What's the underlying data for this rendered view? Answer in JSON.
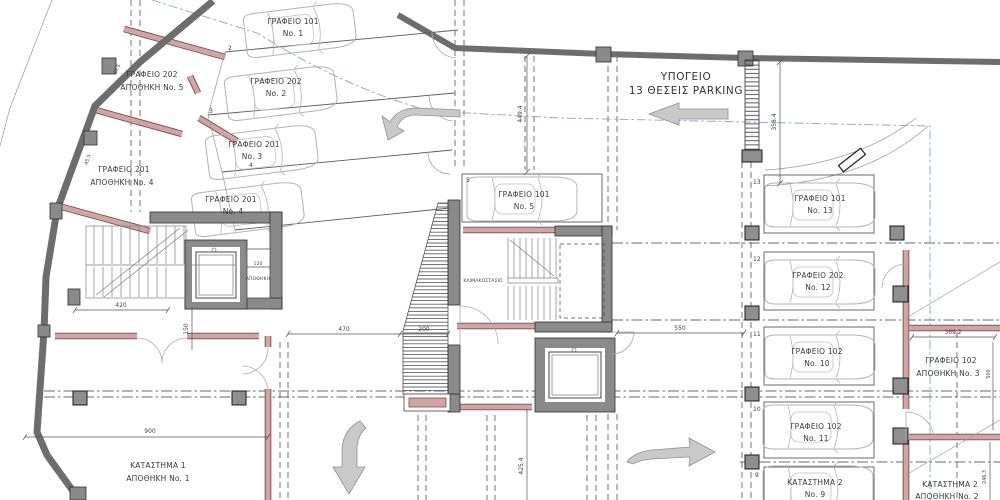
{
  "title": {
    "line1": "ΥΠΟΓΕΙΟ",
    "line2": "13 ΘΕΣΕΙΣ PARKING"
  },
  "stalls": [
    {
      "name": "ΓΡΑΦΕΙΟ 101",
      "num": "No. 1"
    },
    {
      "tag": "2",
      "name": "ΓΡΑΦΕΙΟ 202",
      "num": "No. 2"
    },
    {
      "tag": "3",
      "name": "ΓΡΑΦΕΙΟ 201",
      "num": "No. 3"
    },
    {
      "tag": "4",
      "name": "ΓΡΑΦΕΙΟ 201",
      "num": "No. 4"
    },
    {
      "tag": "5",
      "name": "ΓΡΑΦΕΙΟ 101",
      "num": "No. 5"
    },
    {
      "tag": "13",
      "name": "ΓΡΑΦΕΙΟ 101",
      "num": "No. 13"
    },
    {
      "tag": "12",
      "name": "ΓΡΑΦΕΙΟ 202",
      "num": "No. 12"
    },
    {
      "tag": "11",
      "name": "ΓΡΑΦΕΙΟ 102",
      "num": "No. 10"
    },
    {
      "tag": "10",
      "name": "ΓΡΑΦΕΙΟ 102",
      "num": "No. 11"
    },
    {
      "tag": "9",
      "name": "ΚΑΤΑΣΤΗΜΑ 2",
      "num": "No. 9"
    }
  ],
  "rooms": {
    "storage5": {
      "line1": "ΓΡΑΦΕΙΟ 202",
      "line2": "ΑΠΟΘΗΚΗ No. 5"
    },
    "storage4": {
      "line1": "ΓΡΑΦΕΙΟ 201",
      "line2": "ΑΠΟΘΗΚΗ No. 4"
    },
    "shop1": {
      "line1": "ΚΑΤΑΣΤΗΜΑ 1",
      "line2": "ΑΠΟΘΗΚΗ No. 1"
    },
    "storage3": {
      "line1": "ΓΡΑΦΕΙΟ 102",
      "line2": "ΑΠΟΘΗΚΗ No. 3"
    },
    "storage2": {
      "line1": "ΚΑΤΑΣΤΗΜΑ 2",
      "line2": "ΑΠΟΘΗΚΗ No. 2"
    },
    "small_storage": "ΑΠΟΘΗΚΗ",
    "stairwell": "ΚΛΙΜΑΚΟΣΤΑΣΙΟ"
  },
  "dimensions": {
    "aisle_top": "449.4",
    "ramp_side": "358.4",
    "aisle_right": "550",
    "corridor": "470",
    "ramp_width": "200",
    "stair_width": "420",
    "stair_height": "150",
    "storage_width": "120",
    "shop_width": "900",
    "aisle_bottom": "425.4",
    "room3_width": "369.2",
    "room3_height": "500",
    "room2_height": "246.3",
    "wall_upper": "49.5",
    "wall_lower": "45.5"
  },
  "icons": {
    "car": "car-outline-topview",
    "aisle_arrow": "arrow-left",
    "entry_arrow": "arrow-turn-left",
    "ramp_arrow": "arrow-turn-down",
    "exit_arrow": "arrow-right"
  },
  "colors": {
    "wall_concrete": "#6d6d6d",
    "wall_masonry": "#cfa5a5",
    "masonry_edge": "#7d4b4b",
    "column": "#8f8f8f",
    "centerline": "#8aa2c0",
    "arrow": "#c9c9c9",
    "text": "#3a3a3a"
  }
}
